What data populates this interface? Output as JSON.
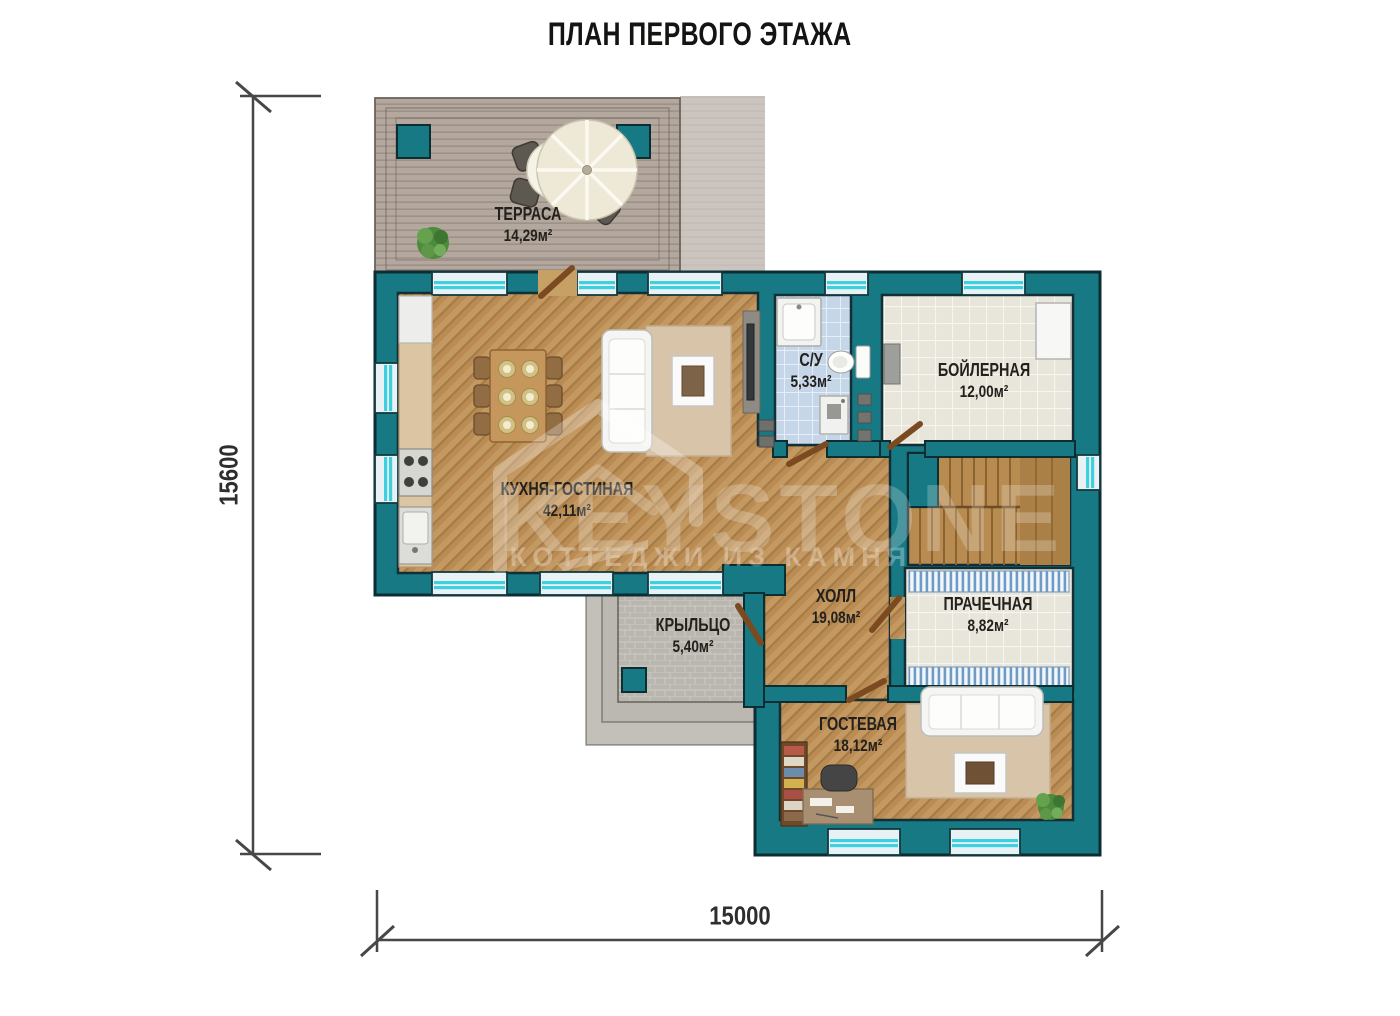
{
  "title": "ПЛАН ПЕРВОГО ЭТАЖА",
  "dimensions": {
    "height_mm": "15600",
    "width_mm": "15000"
  },
  "rooms": {
    "terrace": {
      "name": "ТЕРРАСА",
      "area": "14,29м²"
    },
    "kitchen_living": {
      "name": "КУХНЯ-ГОСТИНАЯ",
      "area": "42,11м²"
    },
    "bathroom": {
      "name": "С/У",
      "area": "5,33м²"
    },
    "boiler": {
      "name": "БОЙЛЕРНАЯ",
      "area": "12,00м²"
    },
    "hall": {
      "name": "ХОЛЛ",
      "area": "19,08м²"
    },
    "laundry": {
      "name": "ПРАЧЕЧНАЯ",
      "area": "8,82м²"
    },
    "porch": {
      "name": "КРЫЛЬЦО",
      "area": "5,40м²"
    },
    "guest": {
      "name": "ГОСТЕВАЯ",
      "area": "18,12м²"
    }
  },
  "watermark": {
    "brand": "KEYSTONE",
    "tagline": "КОТТЕДЖИ ИЗ КАМНЯ"
  },
  "colors": {
    "wall_teal": "#167984",
    "window_cyan": "#3ed0de",
    "wood": "#c49861",
    "outline": "#0c2d31"
  }
}
